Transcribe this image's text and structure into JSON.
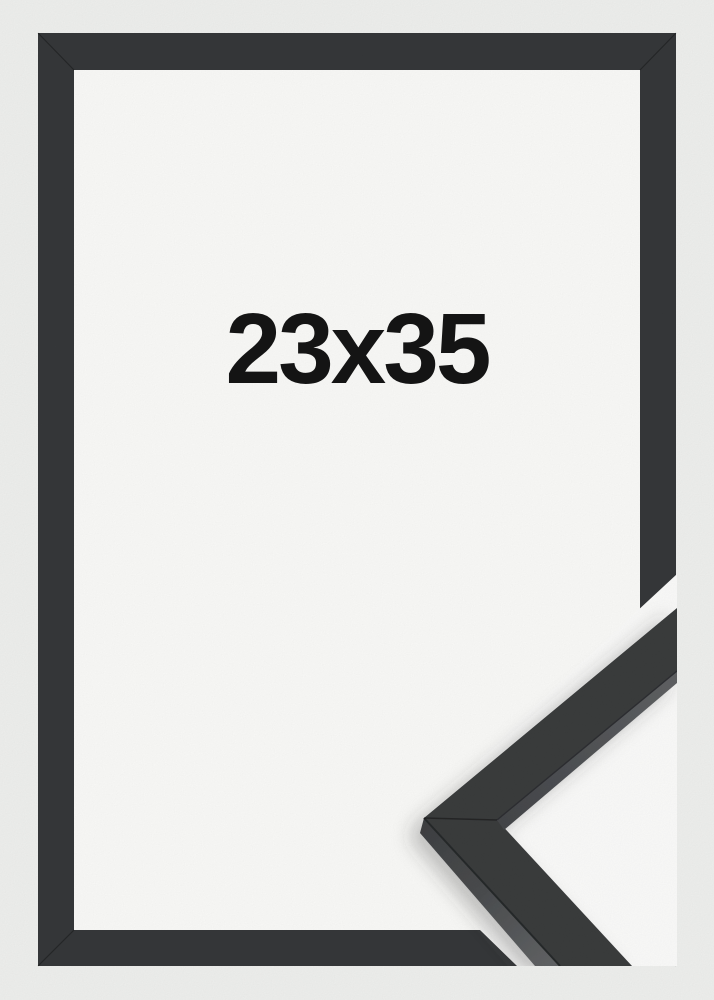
{
  "product_photo": {
    "size_label": "23x35",
    "frame_color_name": "black",
    "colors": {
      "background": "#f0f1ef",
      "frame": "#36383a",
      "frame_edge_seam": "rgba(0,0,0,0.30)",
      "opening": "#fbfbf9",
      "detail_backdrop": "#fcfcfb",
      "label_text": "#141414",
      "profile_top_face": "#3a3c3e",
      "profile_side_dark": "#3e4042",
      "profile_side_light": "#636567",
      "profile_edge_line": "#28292b"
    }
  }
}
